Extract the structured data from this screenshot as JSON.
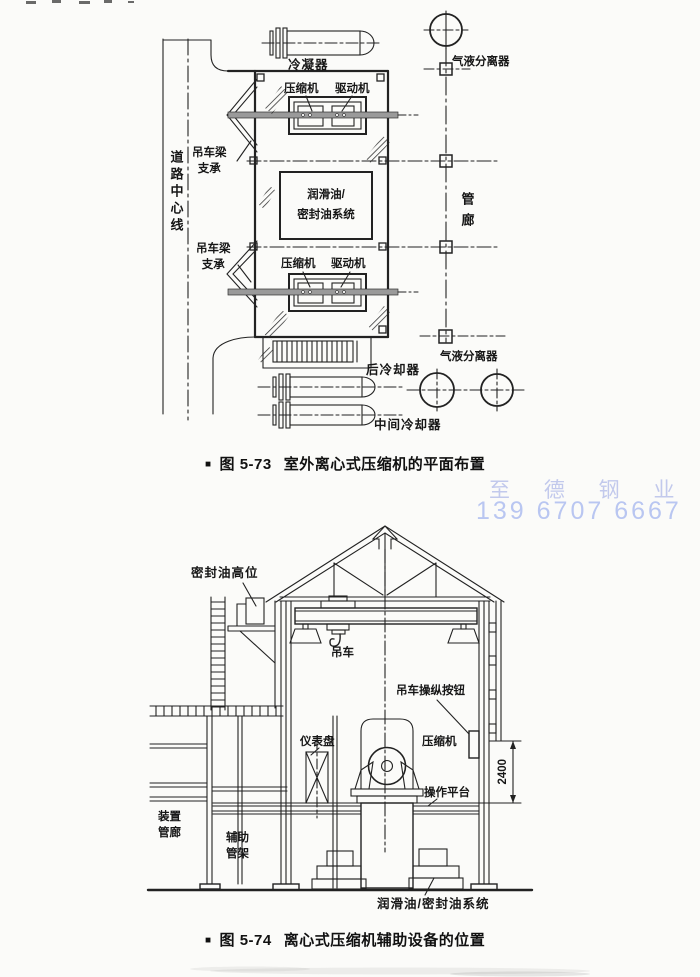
{
  "page": {
    "background": "#fbfbf9",
    "ink": "#1d1d1d"
  },
  "figure1": {
    "caption": {
      "bullet": "■",
      "number": "图 5-73",
      "title": "室外离心式压缩机的平面布置"
    },
    "labels": {
      "road_centerline": "道路中心线",
      "condenser": "冷凝器",
      "compressor_top": "压缩机",
      "driver_top": "驱动机",
      "crane_beam_support_upper": "吊车梁\n支承",
      "lube_seal_oil_system": "润滑油/\n密封油系统",
      "crane_beam_support_lower": "吊车梁\n支承",
      "compressor_bottom": "压缩机",
      "driver_bottom": "驱动机",
      "aftercooler": "后冷却器",
      "intercooler": "中间冷却器",
      "gas_liquid_separator_top": "气液分离器",
      "pipe_gallery": "管廊",
      "gas_liquid_separator_bottom": "气液分离器"
    }
  },
  "watermark": {
    "company": "至 德 钢 业",
    "phone": "139 6707 6667",
    "color": "#bcc6ee"
  },
  "figure2": {
    "caption": {
      "bullet": "■",
      "number": "图 5-74",
      "title": "离心式压缩机辅助设备的位置"
    },
    "labels": {
      "seal_oil_high_tank": "密封油高位",
      "crane": "吊车",
      "crane_control_button": "吊车操纵按钮",
      "instrument_panel": "仪表盘",
      "compressor": "压缩机",
      "dimension_2400": "2400",
      "operating_platform": "操作平台",
      "unit_pipe_gallery": "装置\n管廊",
      "auxiliary_pipe_rack": "辅助\n管架",
      "lube_seal_oil_system": "润滑油/密封油系统"
    }
  }
}
